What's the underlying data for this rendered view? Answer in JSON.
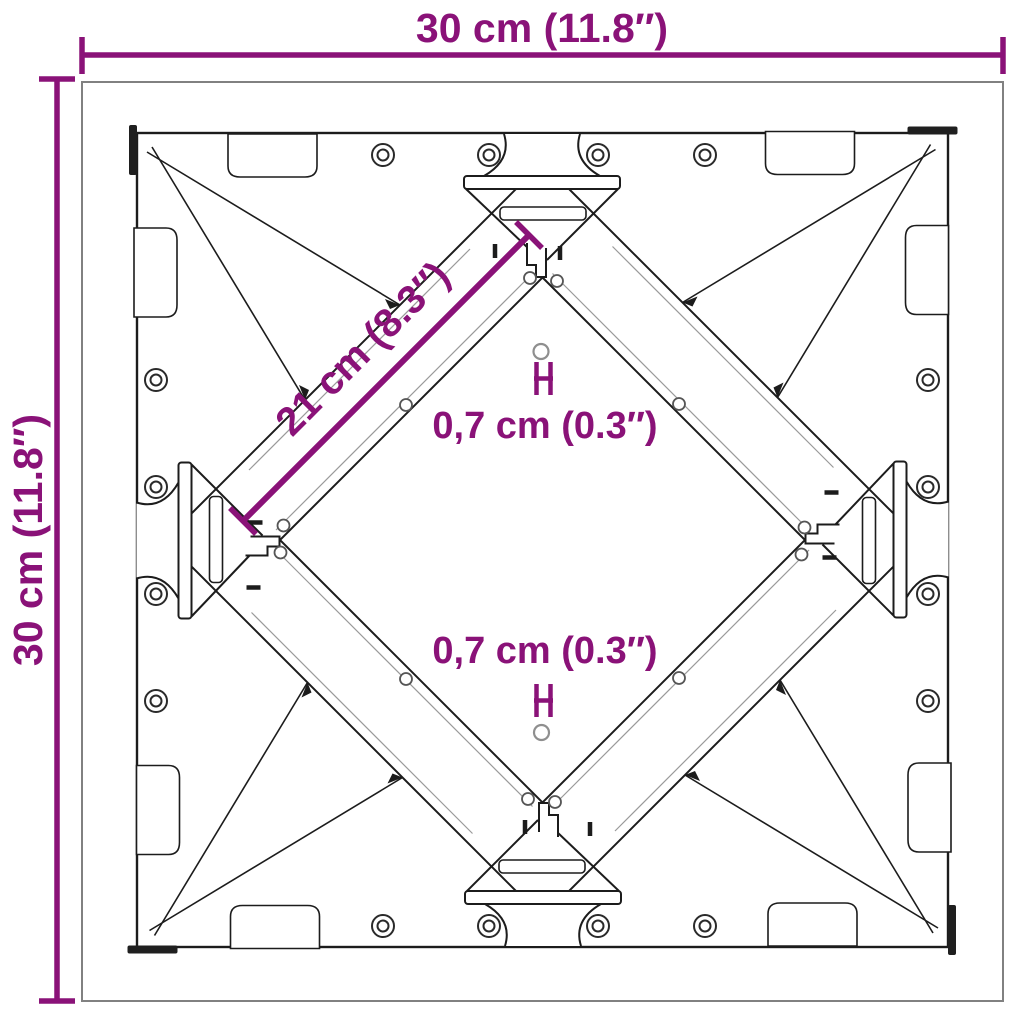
{
  "diagram": {
    "type": "product-dimension-diagram",
    "subject": "square cross-brace frame, top view",
    "labels": {
      "width_top": "30 cm (11.8″)",
      "height_left": "30 cm (11.8″)",
      "diagonal_brace": "21 cm (8.3″)",
      "hole_upper": "0,7 cm (0.3″)",
      "hole_lower": "0,7 cm (0.3″)"
    },
    "colors": {
      "dimension_accent": "#8a1278",
      "drawing_line": "#1c1c1c",
      "outer_border": "#818181",
      "background": "#ffffff"
    }
  }
}
